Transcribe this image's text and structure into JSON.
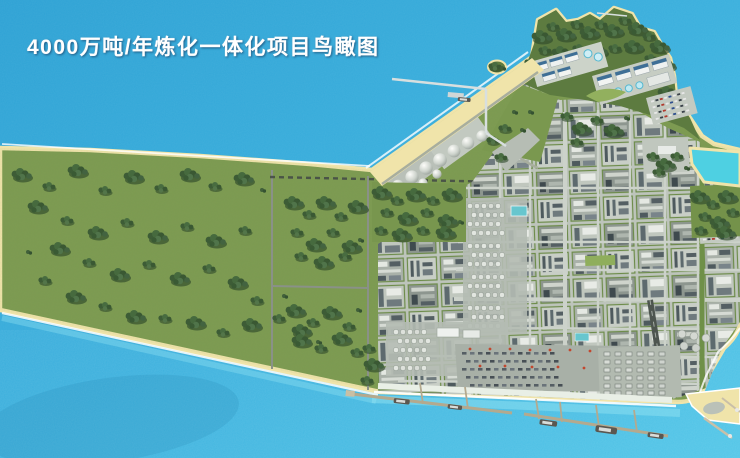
{
  "title": {
    "text": "4000万吨/年炼化一体化项目鸟瞰图"
  },
  "scene": {
    "type": "aerial-3d-rendering",
    "subject": "refining and chemical integration complex, bird's-eye view",
    "features": [
      "sea",
      "forested-greenbelt-wedge",
      "industrial-process-grid",
      "spherical-tank-farm",
      "round-tank-farm",
      "container-yard",
      "jetty",
      "berth-piers",
      "ships",
      "peninsula-hill",
      "water-treatment-plant",
      "lagoon",
      "beach",
      "parking-lots"
    ]
  },
  "palette": {
    "water_base": "#35a9da",
    "water_bright": "#5fd2ec",
    "lagoon": "#4ed0e2",
    "grass": "#7e9c52",
    "trees": "#3d5c36",
    "sand": "#f0e4aa",
    "industrial_pad": "#bdc4bb",
    "equipment_dark": "#4e5a5e",
    "road": "#ccd2ca",
    "title_color": "#ffffff"
  }
}
